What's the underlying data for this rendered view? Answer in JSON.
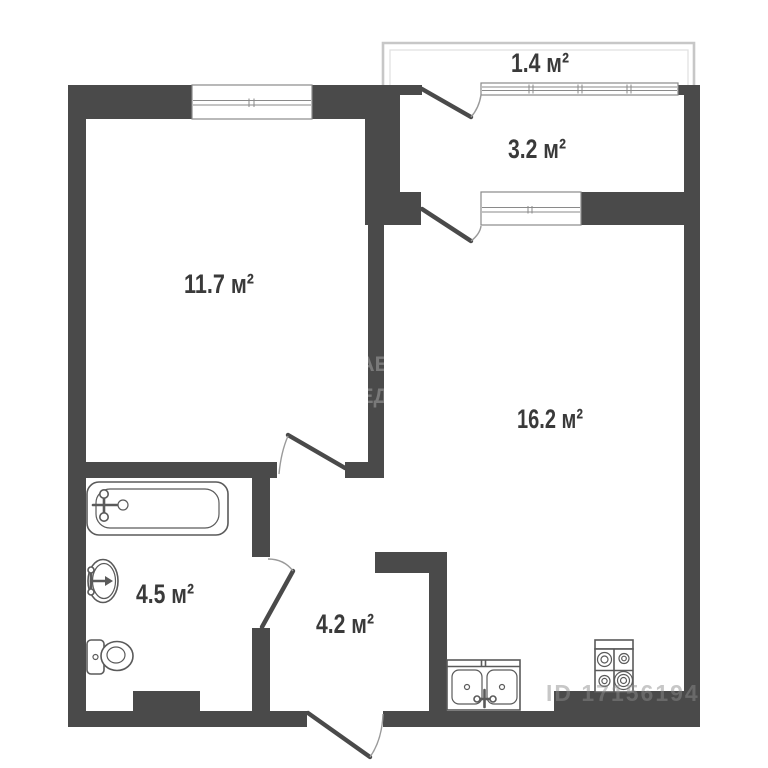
{
  "plan": {
    "type": "apartment-floor-plan",
    "area_unit": "м²",
    "rooms": [
      {
        "id": "balcony",
        "area": 1.4,
        "area_label": "1.4 м²"
      },
      {
        "id": "loggia",
        "area": 3.2,
        "area_label": "3.2 м²"
      },
      {
        "id": "bedroom",
        "area": 11.7,
        "area_label": "11.7 м²"
      },
      {
        "id": "living",
        "area": 16.2,
        "area_label": "16.2 м²"
      },
      {
        "id": "bathroom",
        "area": 4.5,
        "area_label": "4.5 м²"
      },
      {
        "id": "hallway",
        "area": 4.2,
        "area_label": "4.2 м²"
      }
    ],
    "fixtures": [
      "bathtub-icon",
      "washbasin-icon",
      "toilet-icon",
      "kitchen-sink-icon",
      "stove-icon"
    ],
    "watermarks": {
      "listing_id": "ID 17156194",
      "wall_fragment_line1": "АЕ",
      "wall_fragment_line2": "ЕД"
    },
    "colors": {
      "wall": "#4a4a4a",
      "background": "#ffffff",
      "fixture": "#5a5a5a",
      "window_frame": "#8a8a8a",
      "arc": "#9a9a9a",
      "balcony_line": "#c7c7c7",
      "label": "#3a3a3a",
      "watermark": "#8c8c8c"
    }
  }
}
